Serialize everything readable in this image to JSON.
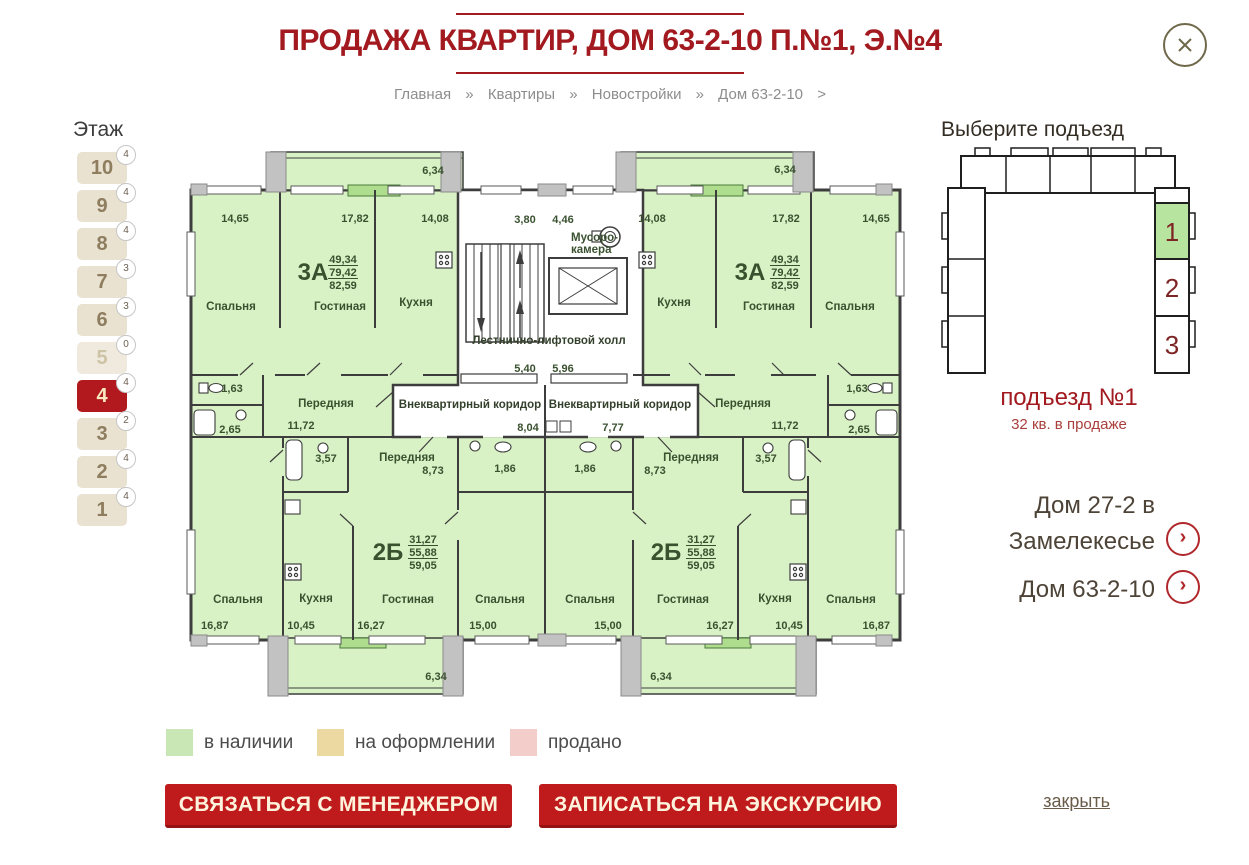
{
  "page": {
    "title": "ПРОДАЖА КВАРТИР, ДОМ 63-2-10 П.№1, Э.№4",
    "close_link": "закрыть"
  },
  "breadcrumb": {
    "items": [
      "Главная",
      "Квартиры",
      "Новостройки",
      "Дом 63-2-10"
    ],
    "separator": "»",
    "trailing": ">"
  },
  "floors": {
    "heading": "Этаж",
    "items": [
      {
        "label": "10",
        "count": "4",
        "state": "normal"
      },
      {
        "label": "9",
        "count": "4",
        "state": "normal"
      },
      {
        "label": "8",
        "count": "4",
        "state": "normal"
      },
      {
        "label": "7",
        "count": "3",
        "state": "normal"
      },
      {
        "label": "6",
        "count": "3",
        "state": "normal"
      },
      {
        "label": "5",
        "count": "0",
        "state": "empty"
      },
      {
        "label": "4",
        "count": "4",
        "state": "active"
      },
      {
        "label": "3",
        "count": "2",
        "state": "normal"
      },
      {
        "label": "2",
        "count": "4",
        "state": "normal"
      },
      {
        "label": "1",
        "count": "4",
        "state": "normal"
      }
    ]
  },
  "entrance": {
    "heading": "Выберите подъезд",
    "cells": [
      {
        "label": "1",
        "active": true
      },
      {
        "label": "2",
        "active": false
      },
      {
        "label": "3",
        "active": false
      }
    ],
    "active_color": "#b7e49e",
    "selected_title": "подъезд №1",
    "selected_subtitle": "32 кв. в продаже"
  },
  "links": [
    {
      "lines": [
        "Дом 27-2 в",
        "Замелекесье"
      ]
    },
    {
      "lines": [
        "Дом 63-2-10"
      ]
    }
  ],
  "legend": [
    {
      "label": "в наличии",
      "color": "#c9e7b4"
    },
    {
      "label": "на оформлении",
      "color": "#ecd9a2"
    },
    {
      "label": "продано",
      "color": "#f2cdc9"
    }
  ],
  "actions": [
    {
      "label": "СВЯЗАТЬСЯ С МЕНЕДЖЕРОМ"
    },
    {
      "label": "ЗАПИСАТЬСЯ НА ЭКСКУРСИЮ"
    }
  ],
  "floorplan": {
    "available_fill": "#d9f2c5",
    "apartments": [
      {
        "type": "3А",
        "position": "upper-left",
        "areas": [
          "49,34",
          "79,42",
          "82,59"
        ],
        "balcony": "6,34",
        "rooms": [
          {
            "name": "Спальня",
            "area": "14,65"
          },
          {
            "name": "Гостиная",
            "area": "17,82"
          },
          {
            "name": "Кухня",
            "area": "14,08"
          },
          {
            "name": "Передняя",
            "area": "11,72"
          },
          {
            "area": "1,63"
          },
          {
            "area": "2,65"
          }
        ]
      },
      {
        "type": "3А",
        "position": "upper-right",
        "areas": [
          "49,34",
          "79,42",
          "82,59"
        ],
        "balcony": "6,34",
        "rooms": [
          {
            "name": "Кухня",
            "area": "14,08"
          },
          {
            "name": "Гостиная",
            "area": "17,82"
          },
          {
            "name": "Спальня",
            "area": "14,65"
          },
          {
            "name": "Передняя",
            "area": "11,72"
          },
          {
            "area": "1,63"
          },
          {
            "area": "2,65"
          }
        ]
      },
      {
        "type": "2Б",
        "position": "lower-left",
        "areas": [
          "31,27",
          "55,88",
          "59,05"
        ],
        "balcony": "6,34",
        "rooms": [
          {
            "name": "Спальня",
            "area": "16,87"
          },
          {
            "name": "Кухня",
            "area": "10,45"
          },
          {
            "name": "Гостиная",
            "area": "16,27"
          },
          {
            "name": "Спальня",
            "area": "15,00"
          },
          {
            "name": "Передняя",
            "area": "8,73"
          },
          {
            "area": "3,57"
          },
          {
            "area": "1,86"
          }
        ]
      },
      {
        "type": "2Б",
        "position": "lower-right",
        "areas": [
          "31,27",
          "55,88",
          "59,05"
        ],
        "balcony": "6,34",
        "rooms": [
          {
            "name": "Спальня",
            "area": "15,00"
          },
          {
            "name": "Гостиная",
            "area": "16,27"
          },
          {
            "name": "Кухня",
            "area": "10,45"
          },
          {
            "name": "Спальня",
            "area": "16,87"
          },
          {
            "name": "Передняя",
            "area": "8,73"
          },
          {
            "area": "3,57"
          },
          {
            "area": "1,86"
          }
        ]
      }
    ],
    "core": {
      "hall": "Лестнично-лифтовой холл",
      "garbage": "Мусоро-камера",
      "corridor": "Внеквартирный коридор",
      "dims": [
        "3,80",
        "4,46",
        "5,40",
        "5,96",
        "8,04",
        "7,77"
      ]
    },
    "labels": [
      {
        "t": "6,34",
        "x": 250,
        "y": 34
      },
      {
        "t": "6,34",
        "x": 602,
        "y": 33
      },
      {
        "t": "14,65",
        "x": 52,
        "y": 82
      },
      {
        "t": "17,82",
        "x": 172,
        "y": 82
      },
      {
        "t": "14,08",
        "x": 252,
        "y": 82
      },
      {
        "t": "3,80",
        "x": 342,
        "y": 83
      },
      {
        "t": "4,46",
        "x": 380,
        "y": 83
      },
      {
        "t": "14,08",
        "x": 469,
        "y": 82
      },
      {
        "t": "17,82",
        "x": 603,
        "y": 82
      },
      {
        "t": "14,65",
        "x": 693,
        "y": 82
      },
      {
        "t": "Мусоро-",
        "x": 388,
        "y": 101,
        "a": "start",
        "cls": "rm"
      },
      {
        "t": "камера",
        "x": 388,
        "y": 113,
        "a": "start",
        "cls": "rm"
      },
      {
        "t": "Спальня",
        "x": 48,
        "y": 170,
        "cls": "rm"
      },
      {
        "t": "Гостиная",
        "x": 157,
        "y": 170,
        "cls": "rm"
      },
      {
        "t": "Кухня",
        "x": 233,
        "y": 166,
        "cls": "rm"
      },
      {
        "t": "Кухня",
        "x": 491,
        "y": 166,
        "cls": "rm"
      },
      {
        "t": "Гостиная",
        "x": 586,
        "y": 170,
        "cls": "rm"
      },
      {
        "t": "Спальня",
        "x": 667,
        "y": 170,
        "cls": "rm"
      },
      {
        "t": "3А",
        "x": 130,
        "y": 140,
        "cls": "big"
      },
      {
        "t": "49,34",
        "x": 160,
        "y": 123,
        "ul": 1
      },
      {
        "t": "79,42",
        "x": 160,
        "y": 136,
        "ul": 1
      },
      {
        "t": "82,59",
        "x": 160,
        "y": 149
      },
      {
        "t": "3А",
        "x": 567,
        "y": 140,
        "cls": "big"
      },
      {
        "t": "49,34",
        "x": 602,
        "y": 123,
        "ul": 1
      },
      {
        "t": "79,42",
        "x": 602,
        "y": 136,
        "ul": 1
      },
      {
        "t": "82,59",
        "x": 602,
        "y": 149
      },
      {
        "t": "Лестнично-лифтовой холл",
        "x": 366,
        "y": 204,
        "cls": "core"
      },
      {
        "t": "5,40",
        "x": 342,
        "y": 232
      },
      {
        "t": "5,96",
        "x": 380,
        "y": 232
      },
      {
        "t": "1,63",
        "x": 49,
        "y": 252
      },
      {
        "t": "2,65",
        "x": 47,
        "y": 293
      },
      {
        "t": "Передняя",
        "x": 143,
        "y": 267,
        "cls": "rm"
      },
      {
        "t": "11,72",
        "x": 118,
        "y": 289
      },
      {
        "t": "Внеквартирный коридор",
        "x": 287,
        "y": 268,
        "cls": "core"
      },
      {
        "t": "Внеквартирный коридор",
        "x": 437,
        "y": 268,
        "cls": "core"
      },
      {
        "t": "8,04",
        "x": 345,
        "y": 291
      },
      {
        "t": "7,77",
        "x": 430,
        "y": 291
      },
      {
        "t": "Передняя",
        "x": 560,
        "y": 267,
        "cls": "rm"
      },
      {
        "t": "11,72",
        "x": 602,
        "y": 289
      },
      {
        "t": "1,63",
        "x": 674,
        "y": 252
      },
      {
        "t": "2,65",
        "x": 676,
        "y": 293
      },
      {
        "t": "3,57",
        "x": 143,
        "y": 322
      },
      {
        "t": "Передняя",
        "x": 224,
        "y": 321,
        "cls": "rm"
      },
      {
        "t": "8,73",
        "x": 250,
        "y": 334
      },
      {
        "t": "1,86",
        "x": 322,
        "y": 332
      },
      {
        "t": "1,86",
        "x": 402,
        "y": 332
      },
      {
        "t": "Передняя",
        "x": 508,
        "y": 321,
        "cls": "rm"
      },
      {
        "t": "8,73",
        "x": 472,
        "y": 334
      },
      {
        "t": "3,57",
        "x": 583,
        "y": 322
      },
      {
        "t": "2Б",
        "x": 205,
        "y": 420,
        "cls": "big"
      },
      {
        "t": "31,27",
        "x": 240,
        "y": 403,
        "ul": 1
      },
      {
        "t": "55,88",
        "x": 240,
        "y": 416,
        "ul": 1
      },
      {
        "t": "59,05",
        "x": 240,
        "y": 429
      },
      {
        "t": "2Б",
        "x": 483,
        "y": 420,
        "cls": "big"
      },
      {
        "t": "31,27",
        "x": 518,
        "y": 403,
        "ul": 1
      },
      {
        "t": "55,88",
        "x": 518,
        "y": 416,
        "ul": 1
      },
      {
        "t": "59,05",
        "x": 518,
        "y": 429
      },
      {
        "t": "Спальня",
        "x": 55,
        "y": 463,
        "cls": "rm"
      },
      {
        "t": "Кухня",
        "x": 133,
        "y": 462,
        "cls": "rm"
      },
      {
        "t": "Гостиная",
        "x": 225,
        "y": 463,
        "cls": "rm"
      },
      {
        "t": "Спальня",
        "x": 317,
        "y": 463,
        "cls": "rm"
      },
      {
        "t": "Спальня",
        "x": 407,
        "y": 463,
        "cls": "rm"
      },
      {
        "t": "Гостиная",
        "x": 500,
        "y": 463,
        "cls": "rm"
      },
      {
        "t": "Кухня",
        "x": 592,
        "y": 462,
        "cls": "rm"
      },
      {
        "t": "Спальня",
        "x": 668,
        "y": 463,
        "cls": "rm"
      },
      {
        "t": "16,87",
        "x": 18,
        "y": 489,
        "a": "start"
      },
      {
        "t": "10,45",
        "x": 118,
        "y": 489
      },
      {
        "t": "16,27",
        "x": 188,
        "y": 489
      },
      {
        "t": "15,00",
        "x": 300,
        "y": 489
      },
      {
        "t": "15,00",
        "x": 425,
        "y": 489
      },
      {
        "t": "16,27",
        "x": 537,
        "y": 489
      },
      {
        "t": "10,45",
        "x": 606,
        "y": 489
      },
      {
        "t": "16,87",
        "x": 707,
        "y": 489,
        "a": "end"
      },
      {
        "t": "6,34",
        "x": 253,
        "y": 540
      },
      {
        "t": "6,34",
        "x": 478,
        "y": 540
      }
    ]
  }
}
